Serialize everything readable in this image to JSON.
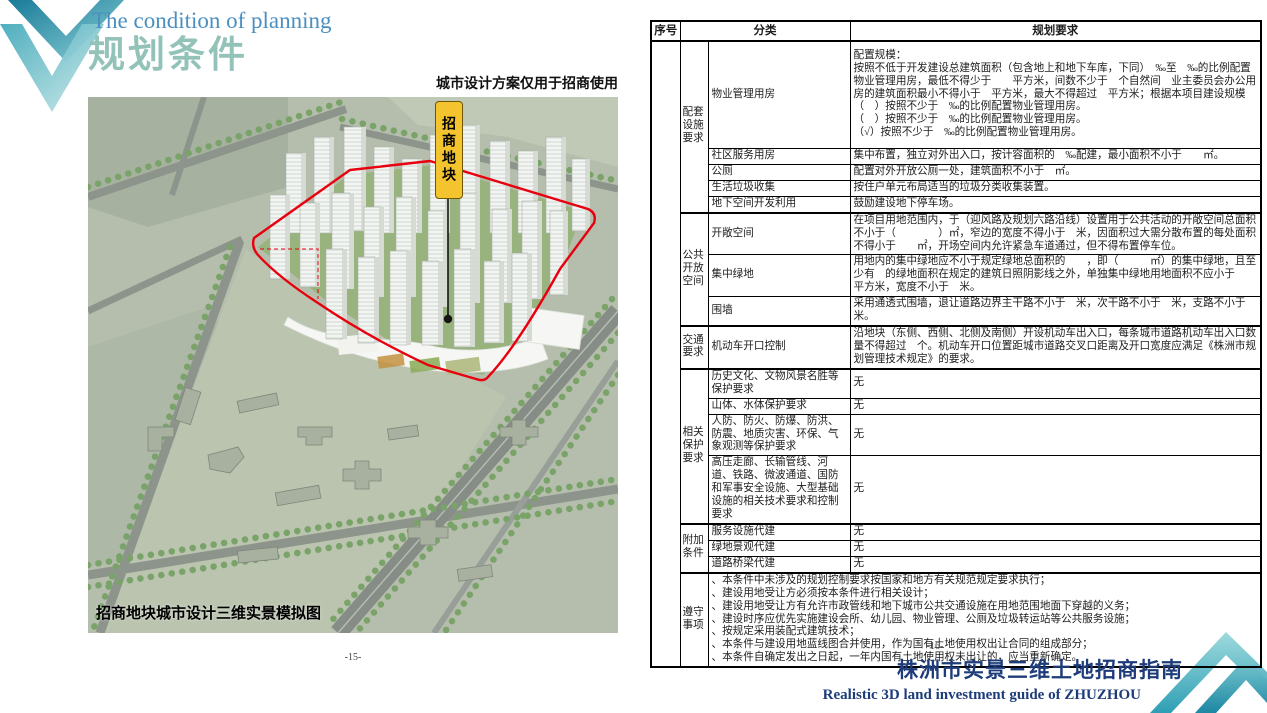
{
  "slide": {
    "title_en": "The condition of planning",
    "title_zh": "规划条件",
    "page_left": "-15-",
    "page_right": "-16-",
    "footer_title_zh": "株洲市实景三维土地招商指南",
    "footer_title_en": "Realistic 3D land investment guide of ZHUZHOU"
  },
  "map": {
    "note_top": "城市设计方案仅用于招商使用",
    "caption": "招商地块城市设计三维实景模拟图",
    "marker_label": "招商地块",
    "boundary_color": "#e8000f",
    "marker_color": "#f4c42e"
  },
  "colors": {
    "accent_teal": "#3aa4b8",
    "title_blue": "#4a8fc0",
    "title_teal": "#93c2b9",
    "footer_navy": "#1e3c7a"
  },
  "table": {
    "headers": [
      "序号",
      "分类",
      "规划要求"
    ],
    "sections": [
      {
        "group": "配套设施要求",
        "rows": [
          {
            "sub": "物业管理用房",
            "req": [
              "配置规模：",
              "按照不低于开发建设总建筑面积（包含地上和地下车库，下同）　‰至　‰的比例配置物业管理用房，最低不得少于　　平方米，间数不少于　个自然间　业主委员会办公用房的建筑面积最小不得小于　平方米，最大不得超过　平方米；根据本项目建设规模",
              "（　）按照不少于　‰的比例配置物业管理用房。",
              "（　）按照不少于　‰的比例配置物业管理用房。",
              "（√）按照不少于　‰的比例配置物业管理用房。"
            ]
          },
          {
            "sub": "社区服务用房",
            "req": "集中布置，独立对外出入口，按计容面积的　‰配建，最小面积不小于　　㎡。"
          },
          {
            "sub": "公厕",
            "req": "配置对外开放公厕一处，建筑面积不小于　㎡。"
          },
          {
            "sub": "生活垃圾收集",
            "req": "按住户单元布局适当的垃圾分类收集装置。"
          },
          {
            "sub": "地下空间开发利用",
            "req": "鼓励建设地下停车场。"
          }
        ]
      },
      {
        "group": "公共开放空间",
        "rows": [
          {
            "sub": "开敞空间",
            "req": "在项目用地范围内，于（迎风路及规划六路沿线）设置用于公共活动的开敞空间总面积不小于（　　　　）㎡，窄边的宽度不得小于　米，因面积过大需分散布置的每处面积不得小于　　㎡，开场空间内允许紧急车道通过，但不得布置停车位。"
          },
          {
            "sub": "集中绿地",
            "req": "用地内的集中绿地应不小于规定绿地总面积的　　，即（　　　㎡）的集中绿地，且至少有　的绿地面积在规定的建筑日照阴影线之外，单独集中绿地用地面积不应小于　　平方米，宽度不小于　米。"
          },
          {
            "sub": "围墙",
            "req": "采用通透式围墙，退让道路边界主干路不小于　米，次干路不小于　米，支路不小于　米。"
          }
        ]
      },
      {
        "group": "交通要求",
        "rows": [
          {
            "sub": "机动车开口控制",
            "req": "沿地块（东侧、西侧、北侧及南侧）开设机动车出入口，每条城市道路机动车出入口数量不得超过　个。机动车开口位置距城市道路交叉口距离及开口宽度应满足《株洲市规划管理技术规定》的要求。"
          }
        ]
      },
      {
        "group": "相关保护要求",
        "rows": [
          {
            "sub": "历史文化、文物风景名胜等保护要求",
            "req": "无"
          },
          {
            "sub": "山体、水体保护要求",
            "req": "无"
          },
          {
            "sub": "人防、防火、防爆、防洪、防震、地质灾害、环保、气象观测等保护要求",
            "req": "无"
          },
          {
            "sub": "高压走廊、长输管线、河道、铁路、微波通道、国防和军事安全设施、大型基础设施的相关技术要求和控制要求",
            "req": "无"
          }
        ]
      },
      {
        "group": "附加条件",
        "rows": [
          {
            "sub": "服务设施代建",
            "req": "无"
          },
          {
            "sub": "绿地景观代建",
            "req": "无"
          },
          {
            "sub": "道路桥梁代建",
            "req": "无"
          }
        ]
      }
    ],
    "notes_group": "遵守事项",
    "notes": [
      "、本条件中未涉及的规划控制要求按国家和地方有关规范规定要求执行；",
      "、建设用地受让方必须按本条件进行相关设计；",
      "、建设用地受让方有允许市政管线和地下城市公共交通设施在用地范围地面下穿越的义务；",
      "、建设时序应优先实施建设会所、幼儿园、物业管理、公厕及垃圾转运站等公共服务设施；",
      "、按规定采用装配式建筑技术；",
      "、本条件与建设用地蓝线图合并使用，作为国有土地使用权出让合同的组成部分；",
      "、本条件自确定发出之日起，一年内国有土地使用权未出让的，应当重新确定。"
    ]
  }
}
